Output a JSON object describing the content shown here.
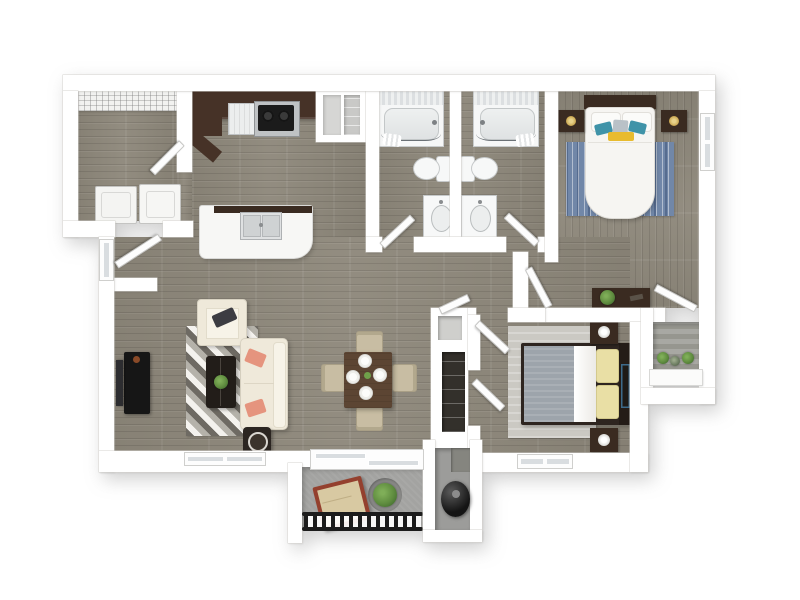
{
  "scene": "3d-apartment-floor-plan-top-view",
  "colors": {
    "wall": "#ffffff",
    "wallEdge": "#d6d4d0",
    "wood": "#8e887b",
    "counter": "#463227",
    "espresso": "#3a2b21",
    "steel": "#bfc2c4",
    "appliance_black": "#1d1d1d",
    "island": "#f7f7f5",
    "cream": "#efe9da",
    "coral": "#e5947e",
    "rug_dark": "#6e6a63",
    "rug_mid": "#b5b2aa",
    "rug_light": "#f4f2ee",
    "blue_rug": "#7187a8",
    "teal": "#3f93a8",
    "accent_yellow": "#e8bb2e",
    "tan": "#c8bda3",
    "dining_table": "#5c4533",
    "blanket_gray": "#9da4ab",
    "pillow_yellow": "#e9dfa5",
    "concrete": "#a3a3a1",
    "deck": "#a8a8a3",
    "plant": "#5f8c3f",
    "light_rug": "#cbc9c3",
    "glass": "#d9dde0",
    "gold": "#c9a54e",
    "railing": "#1c1c1c"
  },
  "rooms": [
    {
      "id": "laundry-room",
      "contents": [
        "wire-shelf",
        "washer",
        "dryer"
      ]
    },
    {
      "id": "kitchen",
      "contents": [
        "counter",
        "dishwasher",
        "range",
        "pantry",
        "island-with-double-sink"
      ]
    },
    {
      "id": "bathroom-1",
      "contents": [
        "bathtub",
        "toilet",
        "vanity-sink"
      ]
    },
    {
      "id": "bathroom-2",
      "contents": [
        "bathtub",
        "toilet",
        "vanity-sink"
      ]
    },
    {
      "id": "bedroom-1",
      "contents": [
        "bed",
        "nightstand-left",
        "nightstand-right",
        "blue-rug",
        "wall-art",
        "dresser",
        "window"
      ]
    },
    {
      "id": "bedroom-2",
      "contents": [
        "bed",
        "nightstand-top",
        "nightstand-bottom",
        "light-rug",
        "wall-art",
        "window",
        "closet"
      ]
    },
    {
      "id": "living-room",
      "contents": [
        "tv",
        "tv-console",
        "armchair",
        "sofa",
        "coffee-table",
        "side-table",
        "patterned-rug",
        "window"
      ]
    },
    {
      "id": "dining-area",
      "contents": [
        "dining-table",
        "chairs-4",
        "plates-4"
      ]
    },
    {
      "id": "hallway",
      "contents": [
        "linen-closet"
      ]
    },
    {
      "id": "patio",
      "contents": [
        "bistro-table",
        "potted-plant",
        "railing",
        "sliding-glass-door"
      ]
    },
    {
      "id": "storage-closet",
      "contents": [
        "water-heater"
      ]
    },
    {
      "id": "balcony",
      "contents": [
        "potted-plants",
        "planter-ledge"
      ]
    }
  ]
}
